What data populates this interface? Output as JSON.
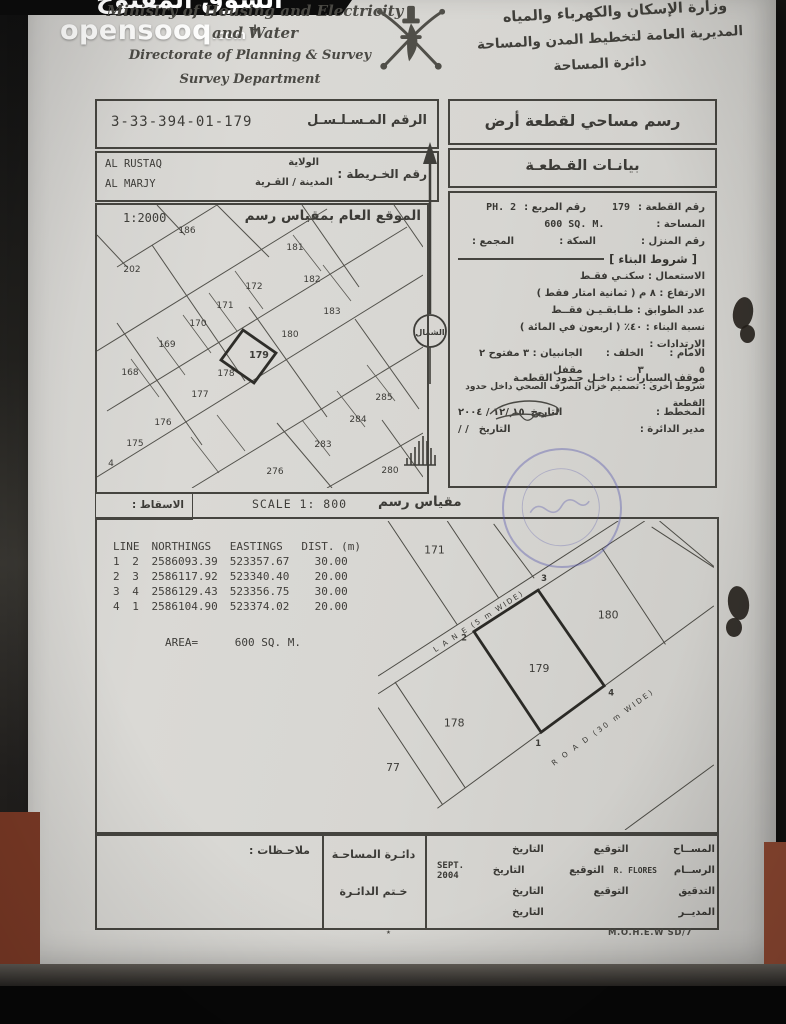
{
  "watermark": {
    "arabic": "السوق المفتوح",
    "brand": "opensooq",
    "tld": ".com"
  },
  "header": {
    "en_line1": "Ministry of Housing and Electricity +",
    "en_line2": "and Water",
    "en_line3": "Directorate of Planning & Survey",
    "en_line4": "Survey Department",
    "ar_line1": "وزارة الإسكان والكهرباء والمياه",
    "ar_line2": "المديرية العامة لتخطيط المدن والمساحة",
    "ar_line3": "دائرة المساحة"
  },
  "serial": {
    "label": "الرقم المـسـلـسـل",
    "value": "3-33-394-01-179"
  },
  "map_info": {
    "label": "رقم الخـريطة :",
    "wilaya_label": "الولاية",
    "wilaya_value": "AL RUSTAQ",
    "town_label": "المدينة / القـرية",
    "town_value": "AL MARJY"
  },
  "titles": {
    "survey_drawing": "رسم مساحي لقطعة أرض",
    "plot_data": "بيانـات القـطعـة"
  },
  "plot_details": {
    "plot_no_label": "رقم القطعة :",
    "plot_no": "179",
    "square_label": "رقم المربع :",
    "square": "PH. 2",
    "area_label": "المساحة :",
    "area": "600 SQ. M.",
    "house_label": "رقم المنزل :",
    "street_label": "السكة :",
    "complex_label": "المجمع :",
    "conditions_title": "[ شروط البناء ]",
    "use": "الاستعمال :  سكنـي فقـط",
    "height": "الارتفاع :  ٨ م ( ثمانية امتار فقط )",
    "floors": "عدد الطوابق :  طـابقـيـن فقــط",
    "ratio": "نسبة البناء :  ٤٠٪ ( اربعون في المائة )",
    "setbacks_label": "الارتدادات :",
    "front": "الامام :  ٥",
    "back": "الخلف :  ٣",
    "sides": "الجانبيان : ٣ مفتوح ٢ مقفل",
    "parking": "موقف السيارات :  داخـل حـدود القطعـة",
    "other": "شروط أخرى : تصميم خزان الصرف الصحي داخل حدود القطعة",
    "planner_label": "المخطط :",
    "planner_date_label": "التاريخ",
    "planner_date": "١٥ /١٢ / ٢٠٠٤",
    "director_label": "مدير الدائرة :",
    "director_date_label": "التاريخ",
    "director_date": "/      /"
  },
  "north": {
    "label": "الشمال"
  },
  "site_plan": {
    "scale": "1:2000",
    "title": "الموقع العام بمقياس رسم",
    "highlighted_plot": "179",
    "plots": [
      {
        "t": "186",
        "x": 90,
        "y": 28
      },
      {
        "t": "202",
        "x": 35,
        "y": 67
      },
      {
        "t": "181",
        "x": 198,
        "y": 45
      },
      {
        "t": "182",
        "x": 215,
        "y": 77
      },
      {
        "t": "172",
        "x": 157,
        "y": 84
      },
      {
        "t": "171",
        "x": 128,
        "y": 103
      },
      {
        "t": "183",
        "x": 235,
        "y": 109
      },
      {
        "t": "170",
        "x": 101,
        "y": 121
      },
      {
        "t": "169",
        "x": 70,
        "y": 142
      },
      {
        "t": "180",
        "x": 193,
        "y": 132
      },
      {
        "t": "179",
        "x": 162,
        "y": 153
      },
      {
        "t": "168",
        "x": 33,
        "y": 170
      },
      {
        "t": "178",
        "x": 129,
        "y": 171
      },
      {
        "t": "177",
        "x": 103,
        "y": 192
      },
      {
        "t": "176",
        "x": 66,
        "y": 220
      },
      {
        "t": "175",
        "x": 38,
        "y": 241
      },
      {
        "t": "4",
        "x": 14,
        "y": 261
      },
      {
        "t": "285",
        "x": 287,
        "y": 195
      },
      {
        "t": "284",
        "x": 261,
        "y": 217
      },
      {
        "t": "283",
        "x": 226,
        "y": 242
      },
      {
        "t": "276",
        "x": 178,
        "y": 269
      },
      {
        "t": "280",
        "x": 293,
        "y": 268
      }
    ]
  },
  "projection": {
    "label": "الاسقاط :",
    "scale_en": "SCALE 1: 800",
    "scale_ar": "مقياس رسم"
  },
  "coordinates": {
    "headers": [
      "LINE",
      "NORTHINGS",
      "EASTINGS",
      "DIST. (m)"
    ],
    "rows": [
      [
        "1",
        "2",
        "2586093.39",
        "523357.67",
        "30.00"
      ],
      [
        "2",
        "3",
        "2586117.92",
        "523340.40",
        "20.00"
      ],
      [
        "3",
        "4",
        "2586129.43",
        "523356.75",
        "30.00"
      ],
      [
        "4",
        "1",
        "2586104.90",
        "523374.02",
        "20.00"
      ]
    ],
    "area_label": "AREA=",
    "area_value": "600 SQ. M."
  },
  "plot_drawing": {
    "lane_label": "L A N E (5 m WIDE)",
    "road_label": "R O A D (30 m WIDE)",
    "labels": [
      {
        "t": "171",
        "x": 57,
        "y": 33
      },
      {
        "t": "180",
        "x": 233,
        "y": 99
      },
      {
        "t": "179",
        "x": 163,
        "y": 153
      },
      {
        "t": "178",
        "x": 77,
        "y": 208
      },
      {
        "t": "77",
        "x": 15,
        "y": 253
      }
    ],
    "corners": [
      {
        "t": "3",
        "x": 168,
        "y": 61
      },
      {
        "t": "2",
        "x": 87,
        "y": 121
      },
      {
        "t": "4",
        "x": 236,
        "y": 177
      },
      {
        "t": "1",
        "x": 162,
        "y": 228
      }
    ]
  },
  "sign_table": {
    "notes_label": "ملاحـظات :",
    "dept_line1": "دائـرة المساحـة",
    "dept_line2": "خـتم الدائـرة",
    "rows": [
      {
        "role": "المســاح",
        "sig": "التوقيع",
        "date": "التاريخ",
        "latin": "",
        "extra": ""
      },
      {
        "role": "الرســام",
        "sig": "التوقيع",
        "date": "التاريخ",
        "latin": "R. FLORES",
        "extra": "SEPT. 2004"
      },
      {
        "role": "التدقيق",
        "sig": "التوقيع",
        "date": "التاريخ",
        "latin": "",
        "extra": ""
      },
      {
        "role": "المديــر",
        "sig": "",
        "date": "التاريخ",
        "latin": "",
        "extra": ""
      }
    ]
  },
  "footer": {
    "doc_ref": "M.O.H.E.W SD/7",
    "mark": "٭"
  },
  "colors": {
    "paper": "#d7d6d2",
    "ink": "#3c3b37",
    "stamp_blue": "#5656ac",
    "brown": "#7c3a26"
  }
}
